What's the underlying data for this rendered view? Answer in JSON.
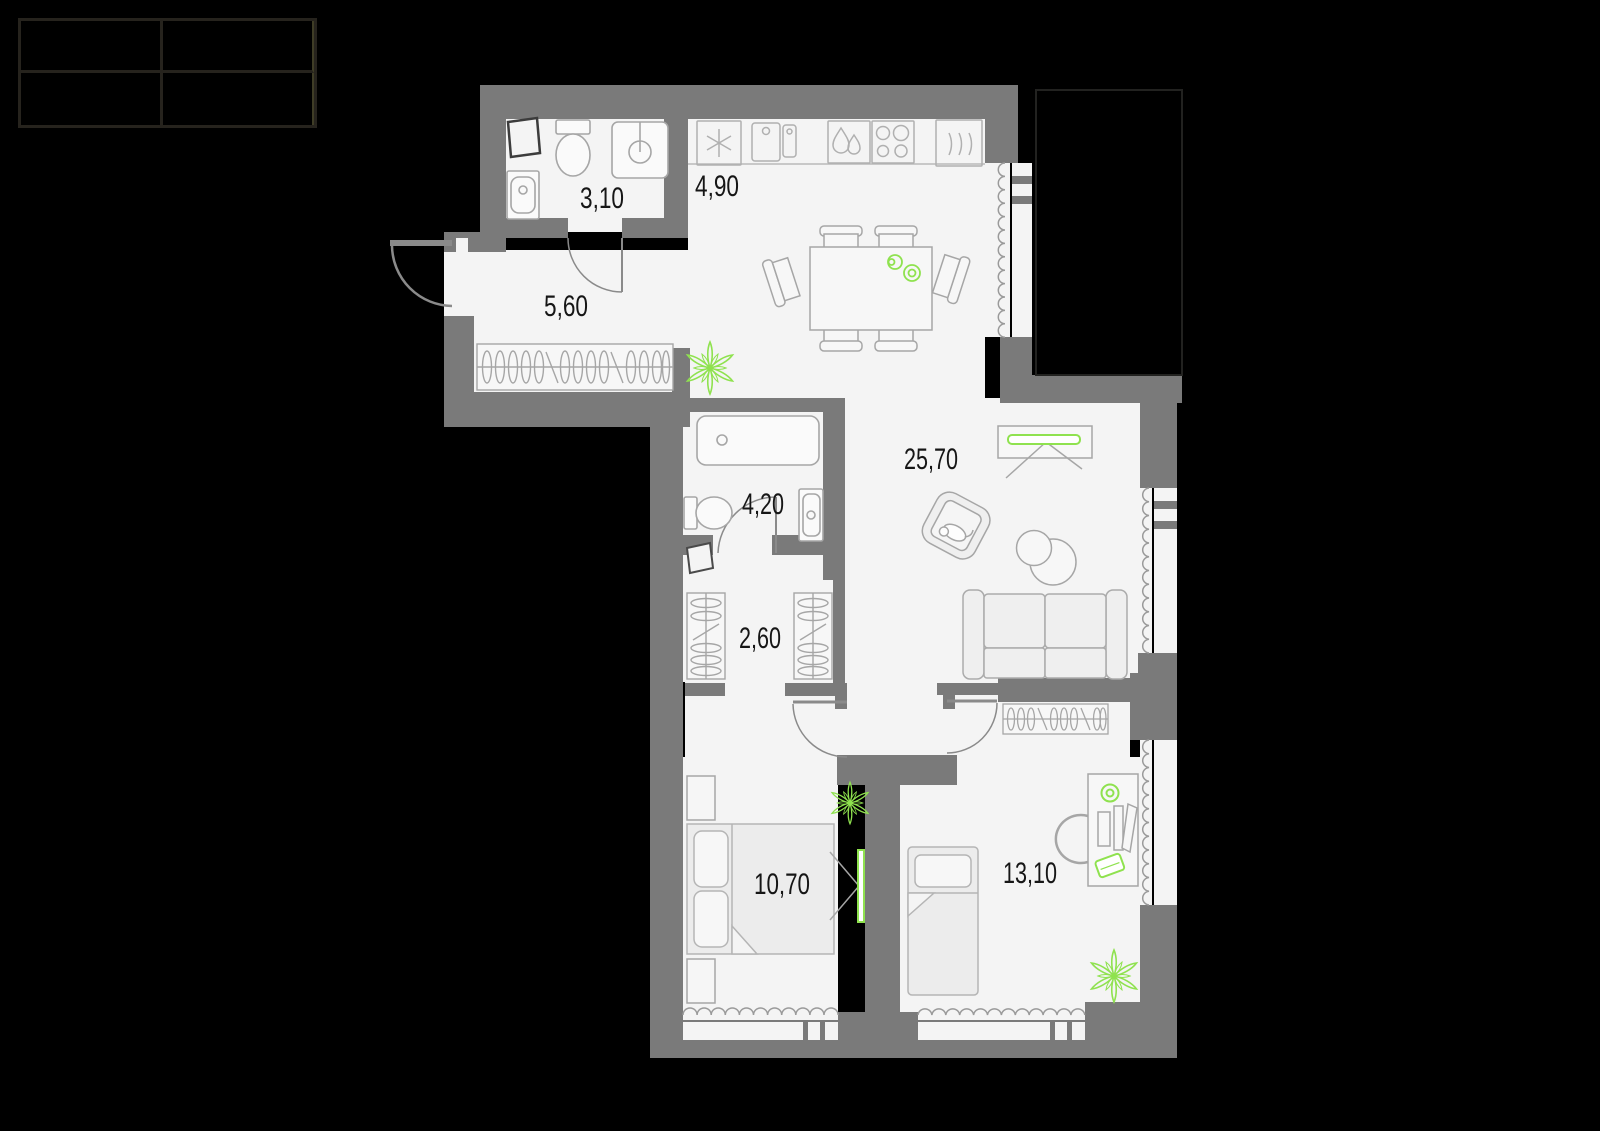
{
  "legend_table": {
    "rows": 2,
    "cols": 2,
    "cells": [
      "",
      "",
      "",
      ""
    ]
  },
  "floor_plan": {
    "background": "#000000",
    "wall_color": "#7a7a7a",
    "floor_color": "#f4f4f4",
    "furniture_line_color": "#a6a6a6",
    "accent_green": "#8fe24f",
    "area_unit": "m2",
    "rooms": [
      {
        "name": "bathroom-small",
        "area_label": "3,10",
        "furniture": [
          "vent-shaft",
          "toilet",
          "shower",
          "sink"
        ]
      },
      {
        "name": "kitchen",
        "area_label": "4,90",
        "furniture": [
          "hood-icon",
          "sink-unit-icon",
          "washing-icon",
          "cooktop-icon",
          "oven-icon",
          "dining-table",
          "chairs",
          "plates"
        ]
      },
      {
        "name": "hallway",
        "area_label": "5,60",
        "furniture": [
          "wardrobe-hangers",
          "entry-door",
          "plant"
        ]
      },
      {
        "name": "living-dining",
        "area_label": "25,70",
        "furniture": [
          "tv-console",
          "armchair-with-cat",
          "coffee-tables",
          "sofa"
        ]
      },
      {
        "name": "bathroom",
        "area_label": "4,20",
        "furniture": [
          "bathtub",
          "toilet",
          "sink",
          "vent-shaft",
          "door"
        ]
      },
      {
        "name": "corridor",
        "area_label": "2,60",
        "furniture": [
          "wardrobe-left",
          "wardrobe-right"
        ]
      },
      {
        "name": "bedroom",
        "area_label": "10,70",
        "furniture": [
          "double-bed",
          "nightstand",
          "nightstand",
          "wall-tv",
          "plant"
        ]
      },
      {
        "name": "bedroom-2",
        "area_label": "13,10",
        "furniture": [
          "single-bed",
          "desk",
          "desk-chair",
          "lamp",
          "laptop",
          "wardrobe-hangers",
          "plant"
        ]
      }
    ]
  }
}
